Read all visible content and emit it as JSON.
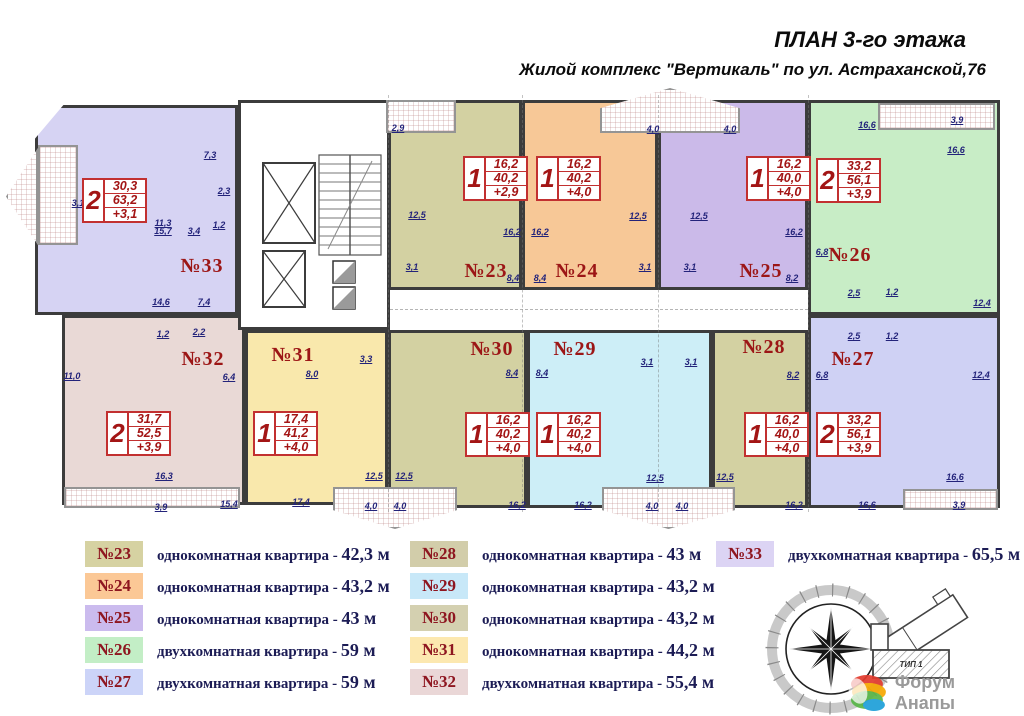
{
  "title": "ПЛАН 3-го этажа",
  "subtitle": "Жилой комплекс \"Вертикаль\" по ул. Астраханской,76",
  "colors": {
    "wall": "#3c3c3c",
    "table_red": "#c23030",
    "apt_label_red": "#9c1616",
    "dim_blue": "#23237a",
    "legend_num_red": "#8e1620",
    "legend_text_navy": "#1c1c55"
  },
  "plan": {
    "apartments": [
      {
        "id": "33",
        "color": "#d6d3f3",
        "x": 35,
        "y": 105,
        "w": 203,
        "h": 210,
        "clip": "polygon(0 16%,14% 0,100% 0,100% 100%,0 100%)"
      },
      {
        "id": "32",
        "color": "#e9d9d6",
        "x": 62,
        "y": 315,
        "w": 183,
        "h": 190
      },
      {
        "id": "31",
        "color": "#f9e8ac",
        "x": 245,
        "y": 330,
        "w": 143,
        "h": 175
      },
      {
        "id": "23",
        "color": "#d3d1a2",
        "x": 388,
        "y": 100,
        "w": 134,
        "h": 190
      },
      {
        "id": "24",
        "color": "#f7c897",
        "x": 522,
        "y": 100,
        "w": 136,
        "h": 190
      },
      {
        "id": "25",
        "color": "#cbbae9",
        "x": 658,
        "y": 100,
        "w": 150,
        "h": 190
      },
      {
        "id": "26",
        "color": "#c8edc6",
        "x": 808,
        "y": 100,
        "w": 192,
        "h": 215
      },
      {
        "id": "27",
        "color": "#cfd1f4",
        "x": 808,
        "y": 315,
        "w": 192,
        "h": 193
      },
      {
        "id": "28",
        "color": "#d3d1a2",
        "x": 712,
        "y": 330,
        "w": 96,
        "h": 178
      },
      {
        "id": "29",
        "color": "#cdeef7",
        "x": 527,
        "y": 330,
        "w": 185,
        "h": 178
      },
      {
        "id": "30",
        "color": "#d3d1a2",
        "x": 388,
        "y": 330,
        "w": 139,
        "h": 178
      }
    ],
    "balconies": [
      {
        "x": 6,
        "y": 148,
        "w": 32,
        "h": 97,
        "shape": "point-left"
      },
      {
        "x": 38,
        "y": 145,
        "w": 40,
        "h": 100,
        "shape": "rect"
      },
      {
        "x": 386,
        "y": 100,
        "w": 70,
        "h": 33,
        "shape": "rect"
      },
      {
        "x": 600,
        "y": 88,
        "w": 140,
        "h": 45,
        "shape": "peak-up"
      },
      {
        "x": 878,
        "y": 103,
        "w": 117,
        "h": 27,
        "shape": "rect"
      },
      {
        "x": 64,
        "y": 487,
        "w": 176,
        "h": 21,
        "shape": "rect"
      },
      {
        "x": 333,
        "y": 487,
        "w": 124,
        "h": 42,
        "shape": "peak-down"
      },
      {
        "x": 602,
        "y": 487,
        "w": 133,
        "h": 42,
        "shape": "peak-down"
      },
      {
        "x": 903,
        "y": 489,
        "w": 95,
        "h": 21,
        "shape": "rect"
      }
    ],
    "apartment_labels": [
      {
        "t": "№33",
        "x": 202,
        "y": 255
      },
      {
        "t": "№32",
        "x": 203,
        "y": 348
      },
      {
        "t": "№31",
        "x": 293,
        "y": 344
      },
      {
        "t": "№23",
        "x": 486,
        "y": 260
      },
      {
        "t": "№24",
        "x": 577,
        "y": 260
      },
      {
        "t": "№25",
        "x": 761,
        "y": 260
      },
      {
        "t": "№26",
        "x": 850,
        "y": 244
      },
      {
        "t": "№27",
        "x": 853,
        "y": 348
      },
      {
        "t": "№28",
        "x": 764,
        "y": 336
      },
      {
        "t": "№29",
        "x": 575,
        "y": 338
      },
      {
        "t": "№30",
        "x": 492,
        "y": 338
      }
    ],
    "area_tables": [
      {
        "x": 82,
        "y": 178,
        "rooms": "2",
        "living": "30,3",
        "total": "63,2",
        "balcony": "+3,1"
      },
      {
        "x": 106,
        "y": 411,
        "rooms": "2",
        "living": "31,7",
        "total": "52,5",
        "balcony": "+3,9"
      },
      {
        "x": 253,
        "y": 411,
        "rooms": "1",
        "living": "17,4",
        "total": "41,2",
        "balcony": "+4,0"
      },
      {
        "x": 463,
        "y": 156,
        "rooms": "1",
        "living": "16,2",
        "total": "40,2",
        "balcony": "+2,9"
      },
      {
        "x": 536,
        "y": 156,
        "rooms": "1",
        "living": "16,2",
        "total": "40,2",
        "balcony": "+4,0"
      },
      {
        "x": 746,
        "y": 156,
        "rooms": "1",
        "living": "16,2",
        "total": "40,0",
        "balcony": "+4,0"
      },
      {
        "x": 816,
        "y": 158,
        "rooms": "2",
        "living": "33,2",
        "total": "56,1",
        "balcony": "+3,9"
      },
      {
        "x": 465,
        "y": 412,
        "rooms": "1",
        "living": "16,2",
        "total": "40,2",
        "balcony": "+4,0"
      },
      {
        "x": 536,
        "y": 412,
        "rooms": "1",
        "living": "16,2",
        "total": "40,2",
        "balcony": "+4,0"
      },
      {
        "x": 744,
        "y": 412,
        "rooms": "1",
        "living": "16,2",
        "total": "40,0",
        "balcony": "+4,0"
      },
      {
        "x": 816,
        "y": 412,
        "rooms": "2",
        "living": "33,2",
        "total": "56,1",
        "balcony": "+3,9"
      }
    ],
    "dimensions": [
      {
        "t": "3,1",
        "x": 78,
        "y": 198
      },
      {
        "t": "7,3",
        "x": 210,
        "y": 150
      },
      {
        "t": "11,3",
        "x": 163,
        "y": 218
      },
      {
        "t": "2,3",
        "x": 224,
        "y": 186
      },
      {
        "t": "1,2",
        "x": 219,
        "y": 220
      },
      {
        "t": "3,4",
        "x": 194,
        "y": 226
      },
      {
        "t": "15,7",
        "x": 163,
        "y": 226
      },
      {
        "t": "14,6",
        "x": 161,
        "y": 297
      },
      {
        "t": "7,4",
        "x": 204,
        "y": 297
      },
      {
        "t": "11,0",
        "x": 72,
        "y": 371
      },
      {
        "t": "1,2",
        "x": 163,
        "y": 329
      },
      {
        "t": "2,2",
        "x": 199,
        "y": 327
      },
      {
        "t": "6,4",
        "x": 229,
        "y": 372
      },
      {
        "t": "16,3",
        "x": 164,
        "y": 471
      },
      {
        "t": "3,9",
        "x": 161,
        "y": 502
      },
      {
        "t": "15,4",
        "x": 229,
        "y": 499
      },
      {
        "t": "8,0",
        "x": 312,
        "y": 369
      },
      {
        "t": "3,3",
        "x": 366,
        "y": 354
      },
      {
        "t": "12,5",
        "x": 374,
        "y": 471
      },
      {
        "t": "17,4",
        "x": 301,
        "y": 497
      },
      {
        "t": "12,5",
        "x": 404,
        "y": 471
      },
      {
        "t": "4,0",
        "x": 371,
        "y": 501
      },
      {
        "t": "4,0",
        "x": 400,
        "y": 501
      },
      {
        "t": "2,9",
        "x": 398,
        "y": 123
      },
      {
        "t": "12,5",
        "x": 417,
        "y": 210
      },
      {
        "t": "16,2",
        "x": 512,
        "y": 227
      },
      {
        "t": "3,1",
        "x": 412,
        "y": 262
      },
      {
        "t": "8,4",
        "x": 513,
        "y": 273
      },
      {
        "t": "8,4",
        "x": 540,
        "y": 273
      },
      {
        "t": "16,2",
        "x": 540,
        "y": 227
      },
      {
        "t": "4,0",
        "x": 653,
        "y": 124
      },
      {
        "t": "12,5",
        "x": 638,
        "y": 211
      },
      {
        "t": "3,1",
        "x": 645,
        "y": 262
      },
      {
        "t": "4,0",
        "x": 730,
        "y": 124
      },
      {
        "t": "12,5",
        "x": 699,
        "y": 211
      },
      {
        "t": "3,1",
        "x": 690,
        "y": 262
      },
      {
        "t": "16,2",
        "x": 794,
        "y": 227
      },
      {
        "t": "8,2",
        "x": 792,
        "y": 273
      },
      {
        "t": "16,6",
        "x": 867,
        "y": 120
      },
      {
        "t": "3,9",
        "x": 957,
        "y": 115
      },
      {
        "t": "16,6",
        "x": 956,
        "y": 145
      },
      {
        "t": "6,8",
        "x": 822,
        "y": 247
      },
      {
        "t": "2,5",
        "x": 854,
        "y": 288
      },
      {
        "t": "1,2",
        "x": 892,
        "y": 287
      },
      {
        "t": "12,4",
        "x": 982,
        "y": 298
      },
      {
        "t": "2,5",
        "x": 854,
        "y": 331
      },
      {
        "t": "1,2",
        "x": 892,
        "y": 331
      },
      {
        "t": "6,8",
        "x": 822,
        "y": 370
      },
      {
        "t": "12,4",
        "x": 981,
        "y": 370
      },
      {
        "t": "8,2",
        "x": 793,
        "y": 370
      },
      {
        "t": "8,4",
        "x": 512,
        "y": 368
      },
      {
        "t": "8,4",
        "x": 542,
        "y": 368
      },
      {
        "t": "3,1",
        "x": 647,
        "y": 357
      },
      {
        "t": "3,1",
        "x": 691,
        "y": 357
      },
      {
        "t": "12,5",
        "x": 655,
        "y": 473
      },
      {
        "t": "12,5",
        "x": 725,
        "y": 472
      },
      {
        "t": "16,2",
        "x": 517,
        "y": 500
      },
      {
        "t": "16,2",
        "x": 583,
        "y": 500
      },
      {
        "t": "4,0",
        "x": 652,
        "y": 501
      },
      {
        "t": "4,0",
        "x": 682,
        "y": 501
      },
      {
        "t": "16,2",
        "x": 794,
        "y": 500
      },
      {
        "t": "16,6",
        "x": 867,
        "y": 500
      },
      {
        "t": "16,6",
        "x": 955,
        "y": 472
      },
      {
        "t": "3,9",
        "x": 959,
        "y": 500
      }
    ]
  },
  "legend": {
    "columns": [
      [
        {
          "num": "№23",
          "color": "#d6d2a2",
          "desc": "однокомнатная квартира",
          "area": "42,3 м"
        },
        {
          "num": "№24",
          "color": "#fbc896",
          "desc": "однокомнатная квартира",
          "area": "43,2 м"
        },
        {
          "num": "№25",
          "color": "#cbbbee",
          "desc": "однокомнатная квартира",
          "area": "43 м"
        },
        {
          "num": "№26",
          "color": "#c3eec6",
          "desc": "двухкомнатная квартира",
          "area": "59 м"
        },
        {
          "num": "№27",
          "color": "#ccd4f8",
          "desc": "двухкомнатная квартира",
          "area": "59 м"
        }
      ],
      [
        {
          "num": "№28",
          "color": "#d2cdaa",
          "desc": "однокомнатная квартира",
          "area": "43 м"
        },
        {
          "num": "№29",
          "color": "#c8e8f8",
          "desc": "однокомнатная квартира",
          "area": "43,2 м"
        },
        {
          "num": "№30",
          "color": "#d4d0b0",
          "desc": "однокомнатная квартира",
          "area": "43,2 м"
        },
        {
          "num": "№31",
          "color": "#fce8b0",
          "desc": "однокомнатная квартира",
          "area": "44,2 м"
        },
        {
          "num": "№32",
          "color": "#ead7d7",
          "desc": "двухкомнатная квартира",
          "area": "55,4 м"
        }
      ],
      [
        {
          "num": "№33",
          "color": "#dcd4f4",
          "desc": "двухкомнатная квартира",
          "area": "65,5 м"
        }
      ]
    ]
  },
  "site_inset": {
    "label": "ТИП 1"
  },
  "watermark": {
    "line1": "Форум Анапы",
    "line2": "anapa-forum.ru"
  }
}
